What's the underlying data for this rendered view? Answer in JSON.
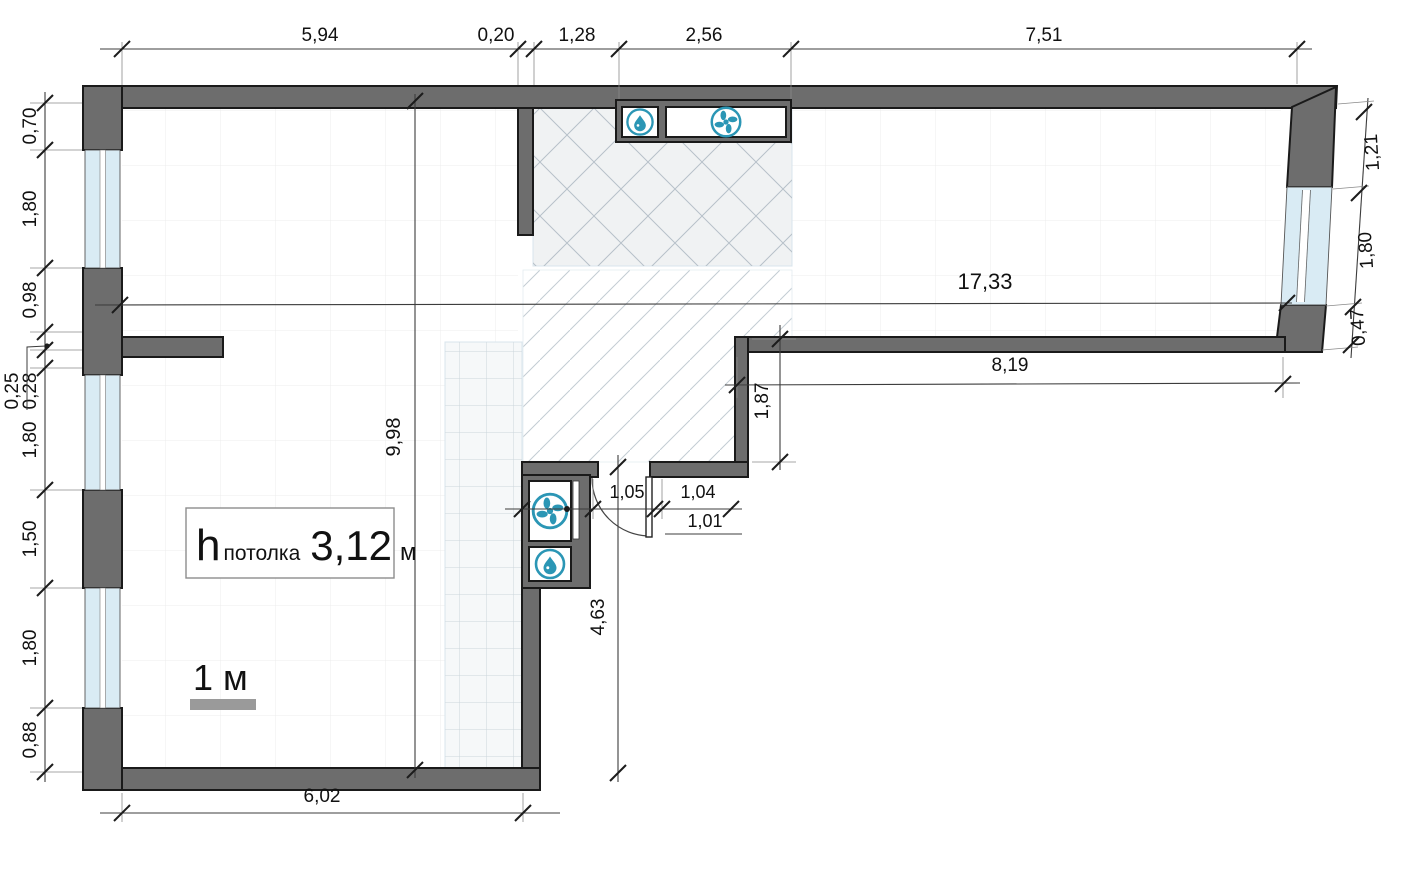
{
  "plan": {
    "type": "apartment floor plan",
    "colors": {
      "wall": "#6d6d6d",
      "wall_outline": "#1a1a1a",
      "window_glass": "#d9ebf4",
      "fixture_blue": "#2b96b5",
      "dimension_text": "#111111",
      "scale_gray": "#9a9a9a"
    },
    "dims": {
      "top": [
        "5,94",
        "0,20",
        "1,28",
        "2,56",
        "7,51"
      ],
      "left": [
        "0,70",
        "1,80",
        "0,98",
        "0,25",
        "0,28",
        "1,80",
        "1,50",
        "1,80",
        "0,88"
      ],
      "right": [
        "1,21",
        "1,80",
        "0,47"
      ],
      "door": [
        "1,05",
        "1,04",
        "1,01"
      ],
      "overall_width": "17,33",
      "wing_width": "8,19",
      "recess_depth": "1,87",
      "room_depth": "9,98",
      "corridor_depth": "4,63",
      "bottom_width": "6,02"
    },
    "ceiling": {
      "h": "h",
      "word": "потолка",
      "value": "3,12",
      "unit": "м"
    },
    "scale_label": "1 м",
    "icons": [
      "water-drop-icon",
      "fan-icon"
    ]
  }
}
